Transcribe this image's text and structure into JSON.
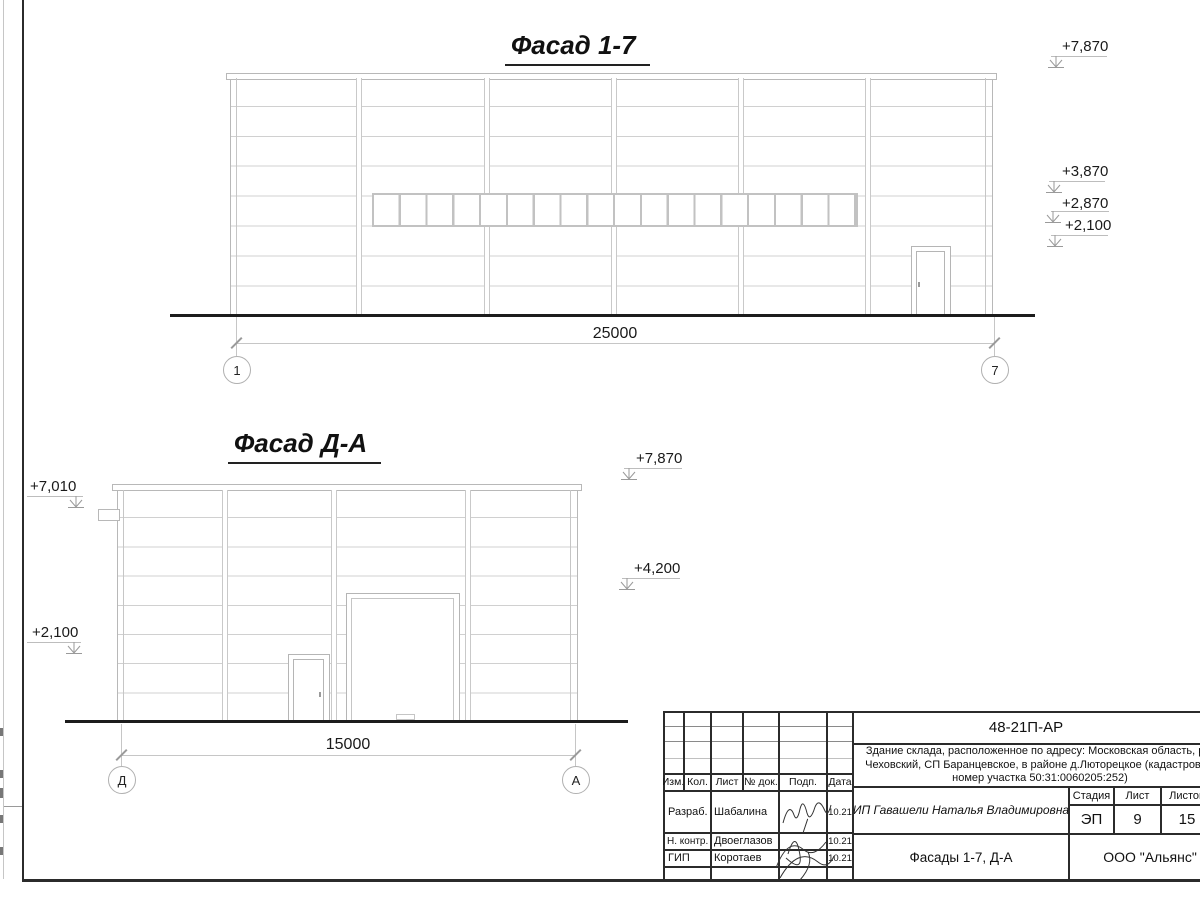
{
  "facade_top": {
    "title": "Фасад 1-7",
    "dimension": "25000",
    "axis_start": "1",
    "axis_end": "7",
    "elev_1": "+7,870",
    "elev_2": "+3,870",
    "elev_3": "+2,870",
    "elev_4": "+2,100"
  },
  "facade_side": {
    "title": "Фасад Д-А",
    "dimension": "15000",
    "axis_start": "Д",
    "axis_end": "А",
    "elev_left_top": "+7,010",
    "elev_left_low": "+2,100",
    "elev_right_top": "+7,870",
    "elev_right_low": "+4,200"
  },
  "title_block": {
    "doc_code": "48-21П-АР",
    "project_name": "Здание склада, расположенное по адресу: Московская область, р-н Чеховский, СП Баранцевское, в районе д.Люторецкое (кадастровый номер участка 50:31:0060205:252)",
    "columns": {
      "izm": "Изм.",
      "kol": "Кол.",
      "list": "Лист",
      "doc": "№ док.",
      "podp": "Подп.",
      "data": "Дата"
    },
    "rows": [
      {
        "role": "Разраб.",
        "name": "Шабалина",
        "date": "10.21"
      },
      {
        "role": "Н. контр.",
        "name": "Двоеглазов",
        "date": "10.21"
      },
      {
        "role": "ГИП",
        "name": "Коротаев",
        "date": "10.21"
      }
    ],
    "client": "ИП Гавашели Наталья Владимировна",
    "stage_label": "Стадия",
    "sheet_label": "Лист",
    "sheets_label": "Листов",
    "stage": "ЭП",
    "sheet_num": "9",
    "sheets_total": "15",
    "sheet_title": "Фасады 1-7, Д-А",
    "company": "ООО \"Альянс\""
  },
  "colors": {
    "line_light": "#c6c6c6",
    "line_dark": "#2b2b2b",
    "ground": "#1c1c1c"
  }
}
